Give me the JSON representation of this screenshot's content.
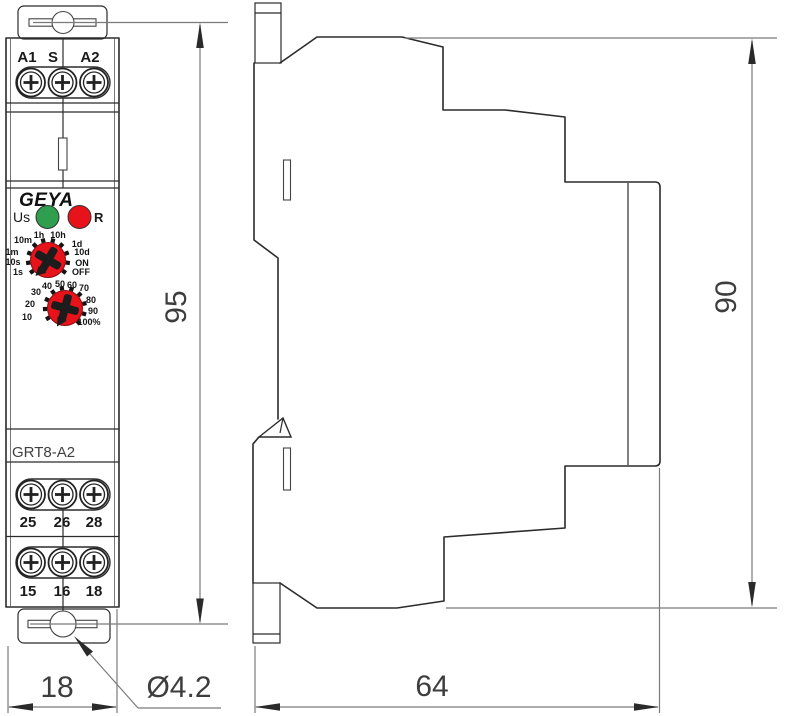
{
  "front_view": {
    "brand": "GEYA",
    "model": "GRT8-A2",
    "top_terminals": [
      "A1",
      "S",
      "A2"
    ],
    "relay_terminals_row1": [
      "25",
      "26",
      "28"
    ],
    "relay_terminals_row2": [
      "15",
      "16",
      "18"
    ],
    "power_led_label": "Us",
    "reset_led_label": "R",
    "time_range_dial_labels": [
      "1h",
      "10h",
      "10m",
      "1d",
      "1m",
      "10d",
      "10s",
      "ON",
      "1s",
      "OFF"
    ],
    "percentage_dial_labels": [
      "10",
      "20",
      "30",
      "40",
      "50",
      "60",
      "70",
      "80",
      "90",
      "100%"
    ]
  },
  "dimensions": {
    "front_height": "95",
    "side_height": "90",
    "front_width": "18",
    "side_depth": "64",
    "hole_diameter": "Ø4.2"
  },
  "colors": {
    "red": "#e8121a",
    "green": "#2f9e4e"
  }
}
